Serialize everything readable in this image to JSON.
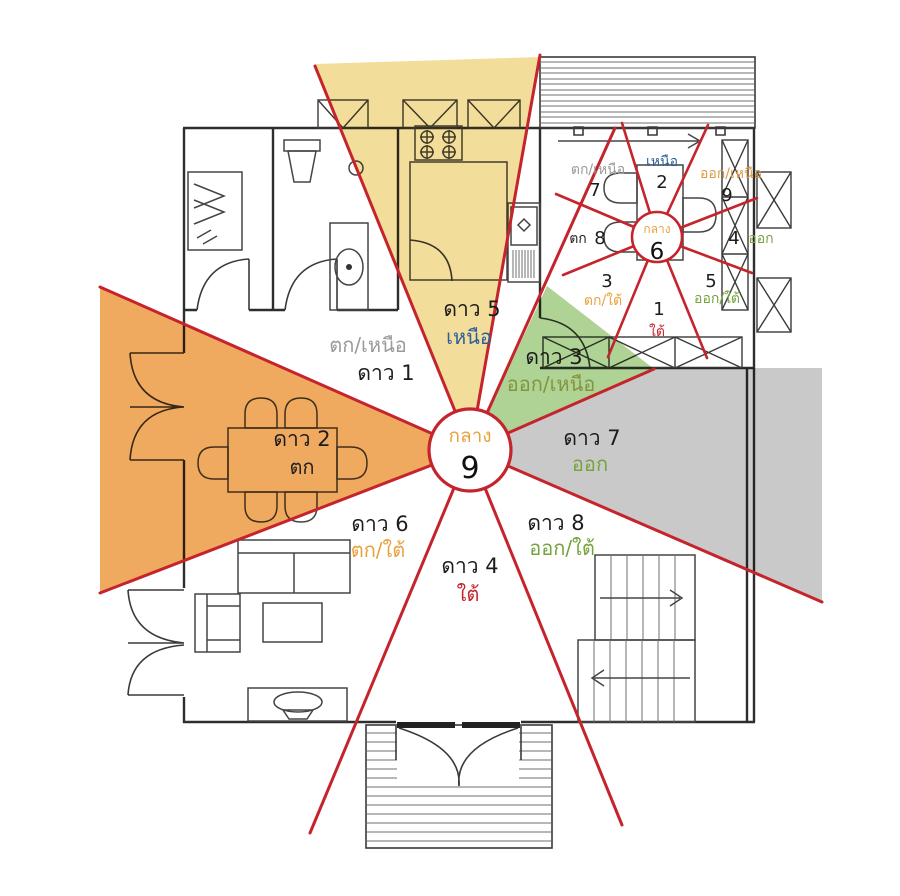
{
  "palette": {
    "line_red": "#c5242c",
    "fill_yellow": "#f3dd9b",
    "fill_green": "#aed394",
    "fill_orange": "#f0aa5f",
    "fill_gray": "#c9c9ca"
  },
  "main_compass": {
    "center_label": "กลาง",
    "center_number": "9",
    "center_label_color": "#e8a33c",
    "sectors": [
      {
        "star": "ดาว 1",
        "direction": "ตก/เหนือ",
        "direction_color": "#9a9a9a"
      },
      {
        "star": "ดาว 5",
        "direction": "เหนือ",
        "direction_color": "#2d5f9a"
      },
      {
        "star": "ดาว 3",
        "direction": "ออก/เหนือ",
        "direction_color": "#83953e"
      },
      {
        "star": "ดาว 2",
        "direction": "ตก",
        "direction_color": "#222222"
      },
      {
        "star": "ดาว 7",
        "direction": "ออก",
        "direction_color": "#76a23f"
      },
      {
        "star": "ดาว 6",
        "direction": "ตก/ใต้",
        "direction_color": "#e8a33c"
      },
      {
        "star": "ดาว 4",
        "direction": "ใต้",
        "direction_color": "#c5242c"
      },
      {
        "star": "ดาว 8",
        "direction": "ออก/ใต้",
        "direction_color": "#76a23f"
      }
    ]
  },
  "mini_compass": {
    "center_label": "กลาง",
    "center_number": "6",
    "center_label_color": "#e8a33c",
    "sectors": [
      {
        "number": "7",
        "direction": "ตก/เหนือ",
        "direction_color": "#9a9a9a"
      },
      {
        "number": "2",
        "direction": "เหนือ",
        "direction_color": "#2d5f9a"
      },
      {
        "number": "9",
        "direction": "ออก/เหนือ",
        "direction_color": "#d99c44"
      },
      {
        "number": "8",
        "direction": "ตก",
        "direction_color": "#222222"
      },
      {
        "number": "4",
        "direction": "ออก",
        "direction_color": "#76a23f"
      },
      {
        "number": "3",
        "direction": "ตก/ใต้",
        "direction_color": "#e8a33c"
      },
      {
        "number": "1",
        "direction": "ใต้",
        "direction_color": "#c5242c"
      },
      {
        "number": "5",
        "direction": "ออก/ใต้",
        "direction_color": "#76a23f"
      }
    ]
  }
}
